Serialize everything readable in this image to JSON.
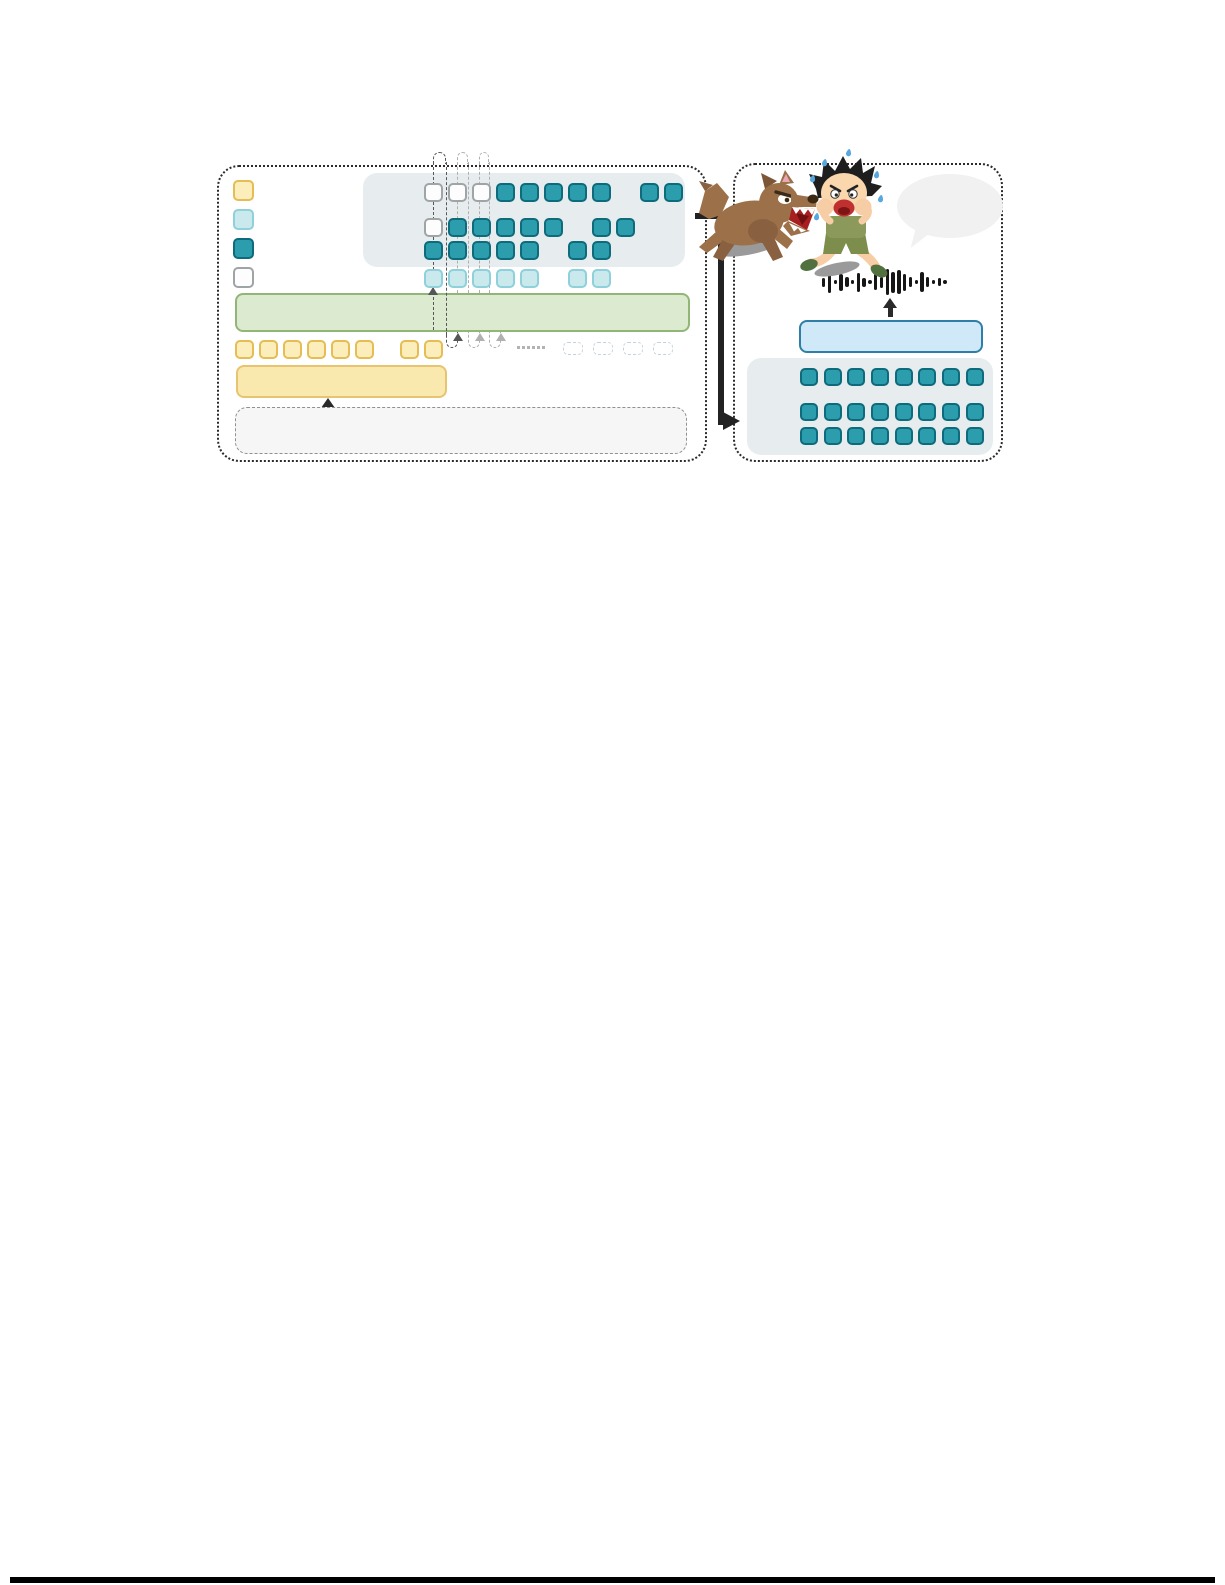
{
  "colors": {
    "teal_fill": "#2b9dad",
    "teal_border": "#0d6b7b",
    "cyan_fill": "#c9e9ed",
    "cyan_border": "#8fd0da",
    "yellow_fill": "#fbeebb",
    "yellow_border": "#e6bd55",
    "white_fill": "#fdfdfd",
    "white_border": "#9fa4a6",
    "panel_bg": "#e7edef",
    "green_bar_fill": "#dcead0",
    "green_bar_border": "#92b677",
    "yellow_bar_fill": "#fae9ae",
    "yellow_bar_border": "#e7c470",
    "blue_bar_fill": "#cfe9f8",
    "blue_bar_border": "#2e7fa8",
    "dashed_box_fill": "#f6f6f7",
    "dashed_box_border": "#909090",
    "loop_dark": "#565656",
    "loop_light": "#b0b0b0",
    "arrow_black": "#2a2a2a",
    "bubble_fill": "#f1f1f1",
    "waveform_color": "#161616"
  },
  "left_panel": {
    "legend": [
      {
        "type": "yellow"
      },
      {
        "type": "cyan"
      },
      {
        "type": "teal"
      },
      {
        "type": "white"
      }
    ],
    "matrix": {
      "col_x0": 424,
      "col_dx": 24,
      "cell_size": 19,
      "rows": [
        {
          "y": 183,
          "cells": [
            [
              0,
              "white"
            ],
            [
              1,
              "white"
            ],
            [
              2,
              "white"
            ],
            [
              3,
              "teal"
            ],
            [
              4,
              "teal"
            ],
            [
              5,
              "teal"
            ],
            [
              6,
              "teal"
            ],
            [
              7,
              "teal"
            ],
            [
              9,
              "teal"
            ],
            [
              10,
              "teal"
            ]
          ]
        },
        {
          "y": 218,
          "cells": [
            [
              0,
              "white"
            ],
            [
              1,
              "teal"
            ],
            [
              2,
              "teal"
            ],
            [
              3,
              "teal"
            ],
            [
              4,
              "teal"
            ],
            [
              5,
              "teal"
            ],
            [
              7,
              "teal"
            ],
            [
              8,
              "teal"
            ]
          ]
        },
        {
          "y": 241,
          "cells": [
            [
              0,
              "teal"
            ],
            [
              1,
              "teal"
            ],
            [
              2,
              "teal"
            ],
            [
              3,
              "teal"
            ],
            [
              4,
              "teal"
            ],
            [
              6,
              "teal"
            ],
            [
              7,
              "teal"
            ]
          ]
        },
        {
          "y": 269,
          "cells": [
            [
              0,
              "cyan"
            ],
            [
              1,
              "cyan"
            ],
            [
              2,
              "cyan"
            ],
            [
              3,
              "cyan"
            ],
            [
              4,
              "cyan"
            ],
            [
              6,
              "cyan"
            ],
            [
              7,
              "cyan"
            ]
          ]
        }
      ]
    },
    "input_row": {
      "y": 340,
      "type": "yellow",
      "xs": [
        235,
        259,
        283,
        307,
        331,
        355,
        400,
        424
      ]
    },
    "ghost_row": {
      "y": 342,
      "xs": [
        563,
        593,
        623,
        653
      ]
    },
    "recurrence": {
      "top_arcs": [
        {
          "x1": 433,
          "x2": 446,
          "tone": "dark"
        },
        {
          "x1": 457,
          "x2": 468,
          "tone": "light"
        },
        {
          "x1": 479,
          "x2": 489,
          "tone": "light"
        }
      ],
      "vlines": [
        {
          "x": 433,
          "y1": 162,
          "y2": 330,
          "tone": "dark"
        },
        {
          "x": 446,
          "y1": 162,
          "y2": 336,
          "tone": "dark"
        },
        {
          "x": 457,
          "y1": 162,
          "y2": 293,
          "tone": "light"
        },
        {
          "x": 468,
          "y1": 162,
          "y2": 293,
          "tone": "light"
        },
        {
          "x": 479,
          "y1": 162,
          "y2": 293,
          "tone": "light"
        },
        {
          "x": 489,
          "y1": 162,
          "y2": 293,
          "tone": "light"
        }
      ],
      "bottom_loops": [
        {
          "x1": 446,
          "x2": 458,
          "tone": "dark"
        },
        {
          "x1": 468,
          "x2": 480,
          "tone": "light"
        },
        {
          "x1": 489,
          "x2": 501,
          "tone": "light"
        }
      ],
      "up_arrowheads": [
        {
          "x": 433,
          "y": 287,
          "tone": "dark"
        },
        {
          "x": 458,
          "y": 333,
          "tone": "dark"
        },
        {
          "x": 480,
          "y": 333,
          "tone": "light"
        },
        {
          "x": 501,
          "y": 333,
          "tone": "light"
        }
      ],
      "ellipsis": {
        "x": 517,
        "y": 346,
        "count": 6,
        "step": 5
      }
    }
  },
  "right_panel": {
    "waveform_bars": [
      9,
      22,
      4,
      17,
      10,
      4,
      19,
      9,
      4,
      16,
      11,
      26,
      21,
      24,
      17,
      10,
      4,
      20,
      10,
      4,
      8,
      4
    ],
    "token_grid": {
      "type": "teal",
      "cell_size": 18,
      "xs": [
        800,
        824,
        847,
        871,
        895,
        918,
        942,
        966
      ],
      "row_ys": [
        368,
        403,
        427
      ]
    }
  }
}
